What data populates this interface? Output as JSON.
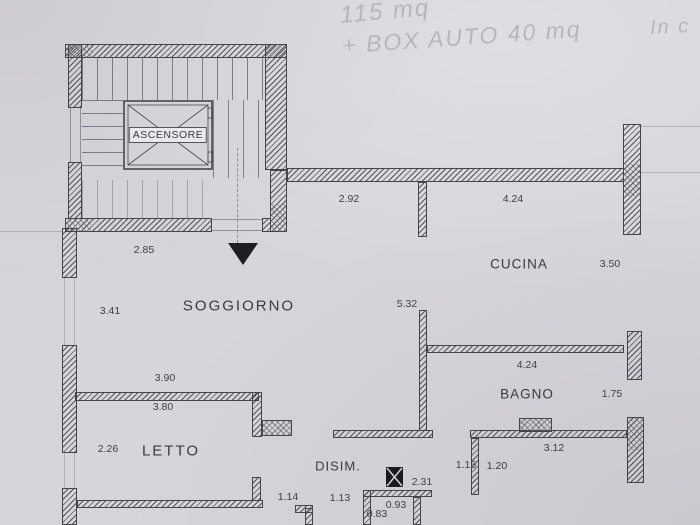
{
  "handwriting": {
    "area_note": "115 mq",
    "garage_note": "+ BOX AUTO 40 mq",
    "corner_note": "In c"
  },
  "rooms": {
    "elevator": "ASCENSORE",
    "kitchen": "CUCINA",
    "living_room": "SOGGIORNO",
    "bathroom": "BAGNO",
    "bedroom": "LETTO",
    "hallway": "DISIM."
  },
  "dimensions": {
    "hall_top_left": "2.92",
    "kitchen_top": "4.24",
    "kitchen_width": "3.50",
    "stair_bottom": "2.85",
    "living_left": "3.41",
    "living_bath_wall": "5.32",
    "bath_top": "4.24",
    "bath_right": "1.75",
    "bed_top_upper": "3.90",
    "bed_top_lower": "3.80",
    "bed_left": "2.26",
    "hall_door_left": "1.14",
    "hall_door_mid": "1.13",
    "jamb_left": "1.15",
    "jamb_right": "1.20",
    "hall_top_right": "3.12",
    "shaft_dim": "2.31",
    "closet_top": "0.93",
    "closet_left": "0.83"
  },
  "colors": {
    "paper": "#d7d6db",
    "ink": "#3f3e45",
    "handwriting": "#b6b3bb"
  }
}
